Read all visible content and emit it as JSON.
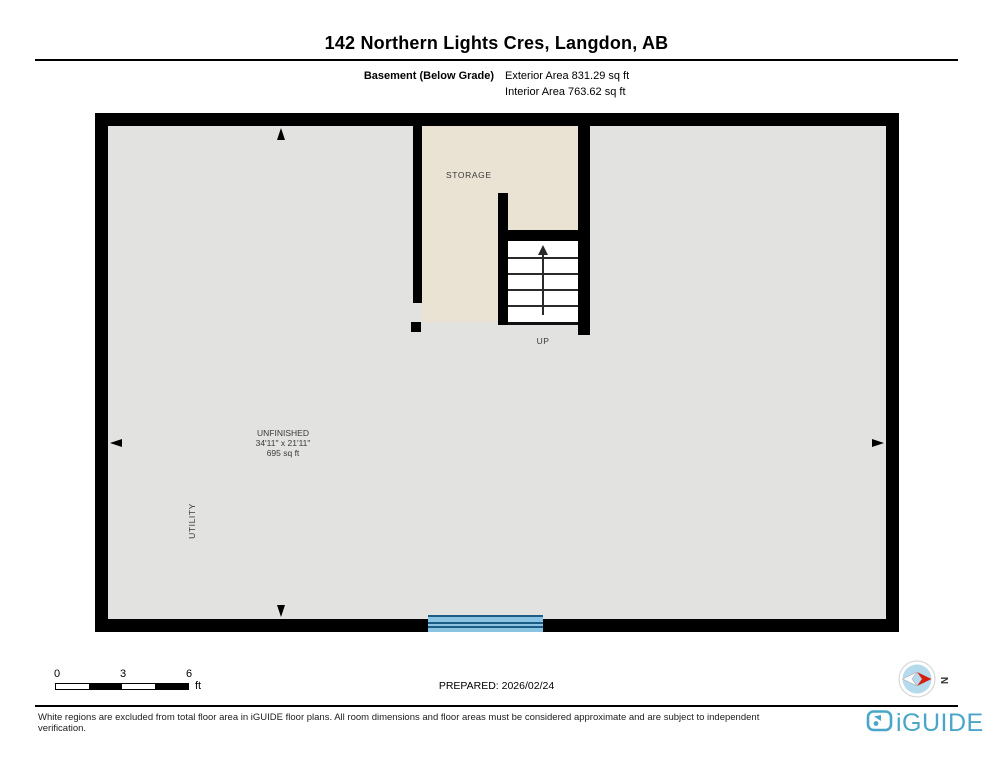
{
  "header": {
    "title": "142 Northern Lights Cres, Langdon, AB",
    "floor_label": "Basement (Below Grade)",
    "exterior_area": "Exterior Area 831.29 sq ft",
    "interior_area": "Interior Area 763.62 sq ft"
  },
  "plan": {
    "rooms": {
      "storage": {
        "label": "STORAGE"
      },
      "stairs": {
        "label": "UP"
      },
      "unfinished": {
        "label": "UNFINISHED",
        "dimensions": "34'11\" x 21'11\"",
        "area": "695 sq ft"
      },
      "utility": {
        "label": "UTILITY"
      }
    },
    "colors": {
      "floor_gray": "#e2e2e1",
      "storage_beige": "#eae2d2",
      "wall_black": "#000000",
      "window_light": "#8bc3e2",
      "window_dark": "#1c5d86"
    }
  },
  "footer": {
    "scale": {
      "ticks": [
        "0",
        "3",
        "6"
      ],
      "unit": "ft"
    },
    "prepared": "PREPARED: 2026/02/24",
    "compass": {
      "label": "N"
    },
    "disclaimer": "White regions are excluded from total floor area in iGUIDE floor plans. All room dimensions and floor areas must be considered approximate and are subject to independent verification.",
    "brand": {
      "name": "iGUIDE",
      "color": "#4aa6c9"
    }
  }
}
